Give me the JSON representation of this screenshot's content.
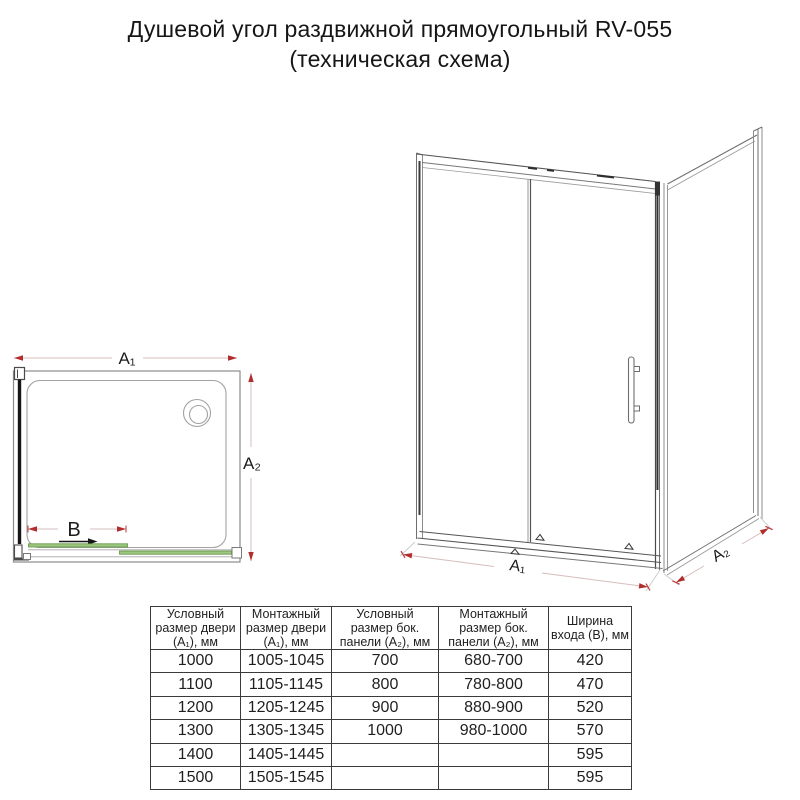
{
  "title": {
    "line1": "Душевой угол раздвижной прямоугольный RV-055",
    "line2": "(техническая схема)"
  },
  "plan_view": {
    "dim_a1": "A₁",
    "dim_a2": "A₂",
    "dim_b": "B"
  },
  "iso_view": {
    "dim_a1": "A₁",
    "dim_a2": "A₂"
  },
  "colors": {
    "dimension_arrow": "#b22d2d",
    "dimension_line": "#d6bdbd",
    "door_glass_green": "#9cc77e",
    "door_glass_green_edge": "#5e9140",
    "drawing_gray": "#8c8c8c",
    "drawing_dark": "#161616"
  },
  "table": {
    "headers": [
      "Условный\nразмер двери\n(A₁), мм",
      "Монтажный\nразмер двери\n(A₁), мм",
      "Условный\nразмер бок.\nпанели (A₂), мм",
      "Монтажный\nразмер бок.\nпанели (A₂), мм",
      "Ширина\nвхода (B), мм"
    ],
    "rows": [
      [
        "1000",
        "1005-1045",
        "700",
        "680-700",
        "420"
      ],
      [
        "1100",
        "1105-1145",
        "800",
        "780-800",
        "470"
      ],
      [
        "1200",
        "1205-1245",
        "900",
        "880-900",
        "520"
      ],
      [
        "1300",
        "1305-1345",
        "1000",
        "980-1000",
        "570"
      ],
      [
        "1400",
        "1405-1445",
        "",
        "",
        "595"
      ],
      [
        "1500",
        "1505-1545",
        "",
        "",
        "595"
      ]
    ]
  }
}
